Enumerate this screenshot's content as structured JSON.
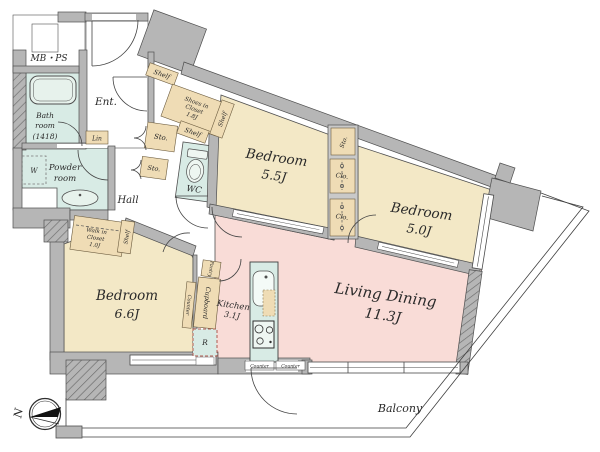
{
  "plan": {
    "rooms": {
      "mbps": {
        "label": "MB・PS"
      },
      "bath": {
        "line1": "Bath",
        "line2": "room",
        "line3": "(1418)"
      },
      "entrance": {
        "label": "Ent."
      },
      "hall": {
        "label": "Hall"
      },
      "shoes_closet": {
        "line1": "Shoes in",
        "line2": "Closet",
        "line3": "1.8J"
      },
      "linen": {
        "label": "Lin"
      },
      "wc": {
        "label": "WC"
      },
      "powder_room": {
        "line1": "Powder",
        "line2": "room"
      },
      "walk_in_closet": {
        "line1": "Walk in",
        "line2": "Closet",
        "line3": "1.0J"
      },
      "bedroom_55": {
        "name": "Bedroom",
        "size": "5.5J"
      },
      "bedroom_50": {
        "name": "Bedroom",
        "size": "5.0J"
      },
      "bedroom_66": {
        "name": "Bedroom",
        "size": "6.6J"
      },
      "living_dining": {
        "name": "Living Dining",
        "size": "11.3J"
      },
      "kitchen": {
        "name": "Kitchen",
        "size": "3.1J"
      },
      "balcony": {
        "label": "Balcony"
      }
    },
    "fixtures": {
      "shelf": "Shelf",
      "storage": "Sto.",
      "closet": "Clo.",
      "counter": "Counter",
      "cupboard": "Cupboard",
      "pantry": "Pantry",
      "refrigerator": "R",
      "washer": "W"
    },
    "compass": {
      "north": "N"
    },
    "colors": {
      "wall": "#b6b6b6",
      "bedroom": "#f3e8c6",
      "living": "#f9dcd7",
      "wet": "#d8ebe5",
      "closet": "#efdcb5",
      "fixture": "#eaf3ee"
    }
  }
}
